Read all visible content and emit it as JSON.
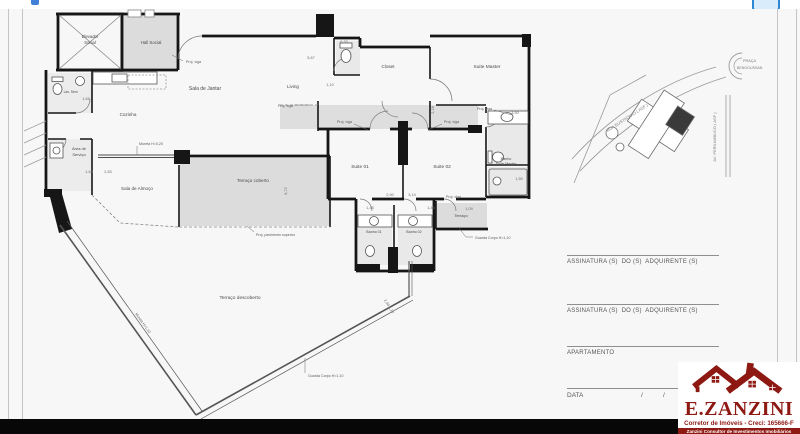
{
  "plan": {
    "rooms": {
      "elevador_1": "Elevador",
      "elevador_2": "Social",
      "hall_social": "Hall Social",
      "lav_serv": "Lav. Serv.",
      "sala_jantar": "Sala de Jantar",
      "cozinha": "Cozinha",
      "living": "Living",
      "area_servico_1": "Área de",
      "area_servico_2": "Serviço",
      "sala_almoco": "Sala de Almoço",
      "terraco_coberto": "Terraço coberto",
      "closet": "Closet",
      "suite_master": "Suite Master",
      "suite_01": "Suite 01",
      "suite_02": "Suite 02",
      "banho_suite_1": "Banho",
      "banho_suite_2": "Suite Master",
      "banho_01": "Banho 01",
      "banho_02": "Banho 02",
      "terraco": "Terraço",
      "terraco_descoberto": "Terraço descoberto"
    },
    "annotations": {
      "proj_viga": "Proj. viga",
      "mureta": "Mureta H=0,20",
      "mureta_diag": "Mureta H=1,10",
      "guarda_corpo": "Guarda Corpo H=1,10",
      "proj_pav": "Proj. pavimento superior"
    },
    "dims": {
      "d633": "6,33",
      "d567": "5,67",
      "d110": "1,10",
      "d165": "1,65",
      "d168": "1,68",
      "d283": "2,83",
      "d672": "6,72",
      "d218": "2,18",
      "d350": "3,50",
      "d150": "1,50",
      "d290": "2,90",
      "d314": "3,14",
      "d145": "1,45",
      "d143": "1,43",
      "d109": "1,09",
      "d290b": "2,90   1,10"
    }
  },
  "map": {
    "rua": "RUA EUSTAQUIO ( ASF )",
    "praca_1": "PRAÇA",
    "praca_2": "BENGOUSSAN",
    "avenida": "AV. PERNAMBUCO ( ASF )"
  },
  "signatures": {
    "assinatura": "ASSINATURA (S)  DO (S)  ADQUIRENTE (S)",
    "apartamento": "APARTAMENTO",
    "data": "DATA",
    "slash": "/"
  },
  "logo": {
    "brand": "E.ZANZINI",
    "subtitle": "Corretor de Imóveis - Creci: 165666-F",
    "tagline": "Zanzini Consultor de Investimentos Imobiliários"
  },
  "colors": {
    "accent_blue": "#2e86d3",
    "logo_red": "#8e1812"
  }
}
